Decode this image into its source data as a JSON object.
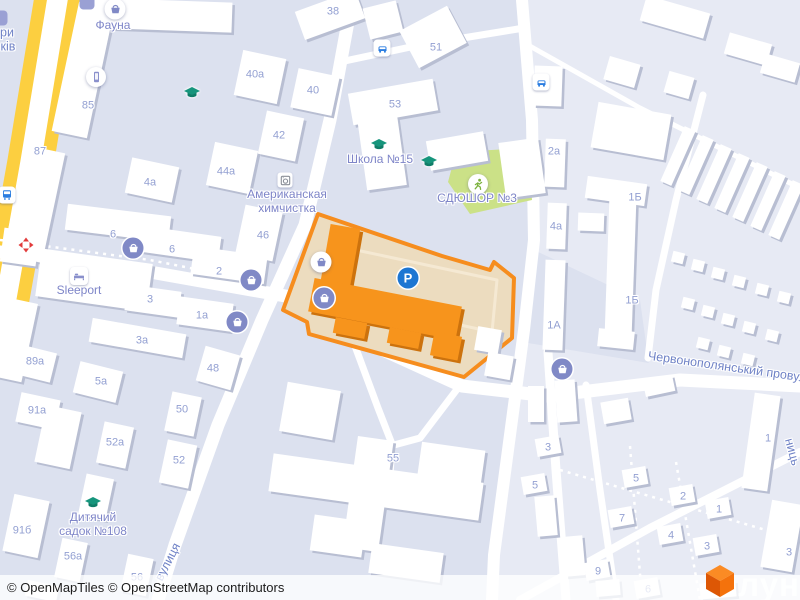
{
  "map": {
    "attribution": "© OpenMapTiles © OpenStreetMap contributors",
    "logo_text": "лун",
    "colors": {
      "background": "#dce1ef",
      "zone_light": "#e7eaf4",
      "road": "#ffffff",
      "highway_yellow": "#fccf40",
      "building": "#ffffff",
      "building_shadow": "#b8bed2",
      "selection_border": "#f68d1e",
      "selection_plot": "#ecdcbf",
      "selected_building": "#f7941e",
      "selected_building_shadow": "#cc7210",
      "sports_field_green": "#cbe187",
      "parking_icon_blue": "#1d76d2",
      "poi_icon_purple": "#8089c6",
      "label_number": "#93a0d2",
      "label_poi": "#7e85c8",
      "label_street": "#6f82c6"
    },
    "labels": [
      {
        "t": "ри",
        "x": 7,
        "y": 33,
        "c": "s"
      },
      {
        "t": "ків",
        "x": 8,
        "y": 47,
        "c": "s"
      },
      {
        "t": "Фауна",
        "x": 113,
        "y": 25,
        "c": "p"
      },
      {
        "t": "38",
        "x": 333,
        "y": 12,
        "c": "n"
      },
      {
        "t": "51",
        "x": 436,
        "y": 48,
        "c": "n"
      },
      {
        "t": "85",
        "x": 88,
        "y": 106,
        "c": "n"
      },
      {
        "t": "40a",
        "x": 255,
        "y": 75,
        "c": "n"
      },
      {
        "t": "40",
        "x": 313,
        "y": 91,
        "c": "n"
      },
      {
        "t": "42",
        "x": 279,
        "y": 136,
        "c": "n"
      },
      {
        "t": "87",
        "x": 40,
        "y": 152,
        "c": "n"
      },
      {
        "t": "53",
        "x": 395,
        "y": 105,
        "c": "n"
      },
      {
        "t": "44a",
        "x": 226,
        "y": 172,
        "c": "n"
      },
      {
        "t": "4a",
        "x": 150,
        "y": 183,
        "c": "n"
      },
      {
        "t": "Школа №15",
        "x": 380,
        "y": 159,
        "c": "p"
      },
      {
        "t": "СДЮШОР №3",
        "x": 477,
        "y": 198,
        "c": "p"
      },
      {
        "t": "Американская\nхимчистка",
        "x": 287,
        "y": 201,
        "c": "p"
      },
      {
        "t": "46",
        "x": 263,
        "y": 236,
        "c": "n"
      },
      {
        "t": "6",
        "x": 113,
        "y": 235,
        "c": "n"
      },
      {
        "t": "6",
        "x": 172,
        "y": 250,
        "c": "n"
      },
      {
        "t": "2",
        "x": 219,
        "y": 272,
        "c": "n"
      },
      {
        "t": "Sleeport",
        "x": 79,
        "y": 290,
        "c": "p"
      },
      {
        "t": "3",
        "x": 150,
        "y": 300,
        "c": "n"
      },
      {
        "t": "1a",
        "x": 202,
        "y": 316,
        "c": "n"
      },
      {
        "t": "3a",
        "x": 142,
        "y": 341,
        "c": "n"
      },
      {
        "t": "89a",
        "x": 35,
        "y": 362,
        "c": "n"
      },
      {
        "t": "5a",
        "x": 101,
        "y": 382,
        "c": "n"
      },
      {
        "t": "48",
        "x": 213,
        "y": 369,
        "c": "n"
      },
      {
        "t": "91a",
        "x": 37,
        "y": 411,
        "c": "n"
      },
      {
        "t": "50",
        "x": 182,
        "y": 410,
        "c": "n"
      },
      {
        "t": "52a",
        "x": 115,
        "y": 443,
        "c": "n"
      },
      {
        "t": "52",
        "x": 179,
        "y": 461,
        "c": "n"
      },
      {
        "t": "2a",
        "x": 554,
        "y": 152,
        "c": "n"
      },
      {
        "t": "1Б",
        "x": 635,
        "y": 198,
        "c": "n"
      },
      {
        "t": "4a",
        "x": 556,
        "y": 227,
        "c": "n"
      },
      {
        "t": "1Б",
        "x": 632,
        "y": 301,
        "c": "n"
      },
      {
        "t": "1A",
        "x": 554,
        "y": 326,
        "c": "n"
      },
      {
        "t": "Червонополянський провулок",
        "x": 648,
        "y": 356,
        "c": "s",
        "r": 8,
        "anchor": "left"
      },
      {
        "t": "91б",
        "x": 22,
        "y": 531,
        "c": "n"
      },
      {
        "t": "Дитячий\nсадок №108",
        "x": 93,
        "y": 524,
        "c": "p"
      },
      {
        "t": "56a",
        "x": 73,
        "y": 557,
        "c": "n"
      },
      {
        "t": "56",
        "x": 137,
        "y": 578,
        "c": "n"
      },
      {
        "t": "55",
        "x": 393,
        "y": 459,
        "c": "n"
      },
      {
        "t": "вулиця",
        "x": 168,
        "y": 562,
        "c": "s",
        "r": -63
      },
      {
        "t": "ниць",
        "x": 792,
        "y": 452,
        "c": "s",
        "r": 75
      },
      {
        "t": "3",
        "x": 548,
        "y": 448,
        "c": "n"
      },
      {
        "t": "5",
        "x": 535,
        "y": 486,
        "c": "n"
      },
      {
        "t": "5",
        "x": 636,
        "y": 479,
        "c": "n"
      },
      {
        "t": "7",
        "x": 622,
        "y": 519,
        "c": "n"
      },
      {
        "t": "2",
        "x": 683,
        "y": 497,
        "c": "n"
      },
      {
        "t": "4",
        "x": 671,
        "y": 536,
        "c": "n"
      },
      {
        "t": "1",
        "x": 719,
        "y": 510,
        "c": "n"
      },
      {
        "t": "3",
        "x": 707,
        "y": 547,
        "c": "n"
      },
      {
        "t": "9",
        "x": 598,
        "y": 572,
        "c": "n"
      },
      {
        "t": "6",
        "x": 648,
        "y": 590,
        "c": "n"
      },
      {
        "t": "1",
        "x": 768,
        "y": 439,
        "c": "n"
      },
      {
        "t": "3",
        "x": 789,
        "y": 553,
        "c": "n"
      }
    ],
    "icons": [
      {
        "type": "shop-square",
        "x": 87,
        "y": 2
      },
      {
        "type": "shop-square",
        "x": 0,
        "y": 18
      },
      {
        "type": "basket-light",
        "x": 115,
        "y": 9
      },
      {
        "type": "mobile-phone",
        "x": 96,
        "y": 77
      },
      {
        "type": "car",
        "x": 382,
        "y": 48
      },
      {
        "type": "car",
        "x": 541,
        "y": 82
      },
      {
        "type": "graduation-cap",
        "x": 192,
        "y": 93
      },
      {
        "type": "graduation-cap",
        "x": 379,
        "y": 145
      },
      {
        "type": "graduation-cap",
        "x": 429,
        "y": 162
      },
      {
        "type": "graduation-cap",
        "x": 93,
        "y": 503
      },
      {
        "type": "sport",
        "x": 478,
        "y": 184
      },
      {
        "type": "laundry",
        "x": 285,
        "y": 180
      },
      {
        "type": "bus",
        "x": 7,
        "y": 195
      },
      {
        "type": "red-arrows",
        "x": 26,
        "y": 245
      },
      {
        "type": "bed",
        "x": 79,
        "y": 276
      },
      {
        "type": "basket",
        "x": 133,
        "y": 248
      },
      {
        "type": "basket",
        "x": 251,
        "y": 280
      },
      {
        "type": "basket",
        "x": 237,
        "y": 322
      },
      {
        "type": "basket-light",
        "x": 321,
        "y": 262
      },
      {
        "type": "basket",
        "x": 324,
        "y": 298
      },
      {
        "type": "parking",
        "x": 408,
        "y": 278,
        "glyph": "P"
      },
      {
        "type": "basket",
        "x": 562,
        "y": 369
      }
    ]
  }
}
